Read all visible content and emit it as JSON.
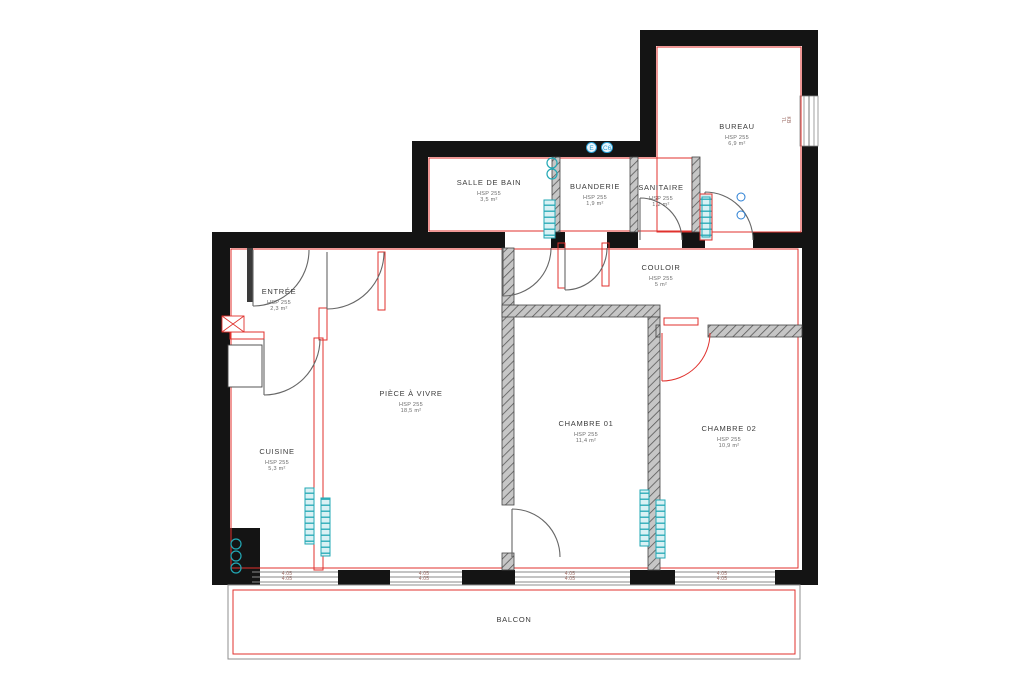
{
  "rooms": [
    {
      "id": "bureau",
      "name": "BUREAU",
      "hsp": "HSP 255",
      "area": "6,9 m²"
    },
    {
      "id": "salle-de-bain",
      "name": "SALLE DE BAIN",
      "hsp": "HSP 255",
      "area": "3,5 m²"
    },
    {
      "id": "buanderie",
      "name": "BUANDERIE",
      "hsp": "HSP 255",
      "area": "1,9 m²"
    },
    {
      "id": "sanitaire",
      "name": "SANITAIRE",
      "hsp": "HSP 255",
      "area": "1,2 m²"
    },
    {
      "id": "couloir",
      "name": "COULOIR",
      "hsp": "HSP 255",
      "area": "5 m²"
    },
    {
      "id": "entree",
      "name": "ENTRÉE",
      "hsp": "HSP 255",
      "area": "2,3 m²"
    },
    {
      "id": "piece-a-vivre",
      "name": "PIÈCE À VIVRE",
      "hsp": "HSP 255",
      "area": "18,5 m²"
    },
    {
      "id": "cuisine",
      "name": "CUISINE",
      "hsp": "HSP 255",
      "area": "5,3 m²"
    },
    {
      "id": "chambre-01",
      "name": "CHAMBRE 01",
      "hsp": "HSP 255",
      "area": "11,4 m²"
    },
    {
      "id": "chambre-02",
      "name": "CHAMBRE 02",
      "hsp": "HSP 255",
      "area": "10,9 m²"
    },
    {
      "id": "balcon",
      "name": "BALCON"
    }
  ],
  "markers": {
    "top_badges": [
      "E",
      "C6"
    ]
  },
  "window_tags": [
    {
      "l1": "4.05",
      "l2": "4.05"
    },
    {
      "l1": "4.05",
      "l2": "4.05"
    },
    {
      "l1": "4.05",
      "l2": "4.05"
    },
    {
      "l1": "4.05",
      "l2": "4.05"
    },
    {
      "l1": "KB",
      "l2": "7L"
    }
  ],
  "colors": {
    "wall": "#141414",
    "liner_red": "#e0312d",
    "door": "#666666",
    "radiator_teal": "#22a8b5",
    "badge_blue": "#2a9fd4"
  }
}
